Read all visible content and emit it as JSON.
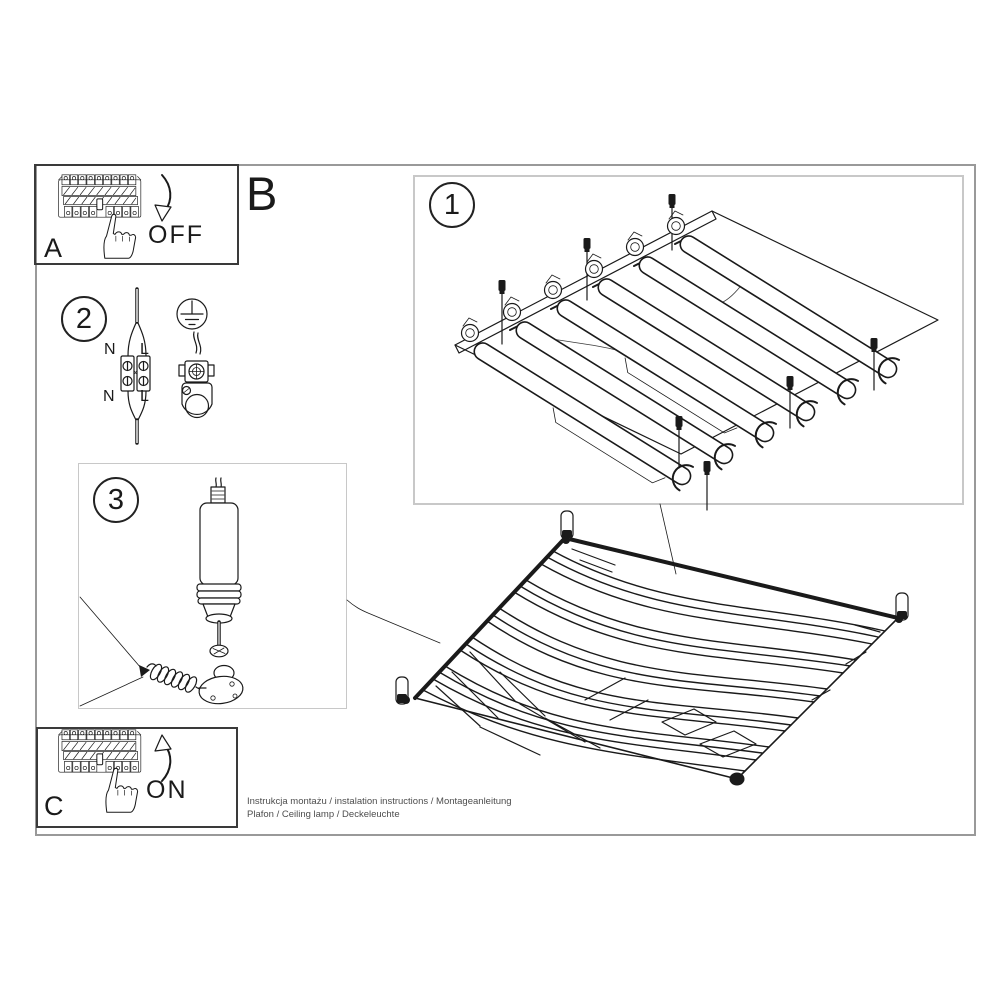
{
  "document_kind": "ceiling lamp installation instruction sheet",
  "captions": {
    "line1": "Instrukcja montażu / instalation instructions / Montageanleitung",
    "line2": "Plafon / Ceiling lamp / Deckeleuchte"
  },
  "panel_a": {
    "label": "A",
    "state": "OFF"
  },
  "panel_b": {
    "label": "B"
  },
  "panel_c": {
    "label": "C",
    "state": "ON"
  },
  "step1": {
    "number": "1"
  },
  "step2": {
    "number": "2",
    "wire_labels": {
      "n_top": "N",
      "l_top": "L",
      "n_bottom": "N",
      "l_bottom": "L"
    }
  },
  "step3": {
    "number": "3"
  },
  "colors": {
    "line": "#1a1a1a",
    "outer_border": "#999999",
    "step_box_border": "#c8c8c8",
    "panel_box_border": "#3a3a3a",
    "caption": "#4d4d4d",
    "paper": "#ffffff"
  }
}
